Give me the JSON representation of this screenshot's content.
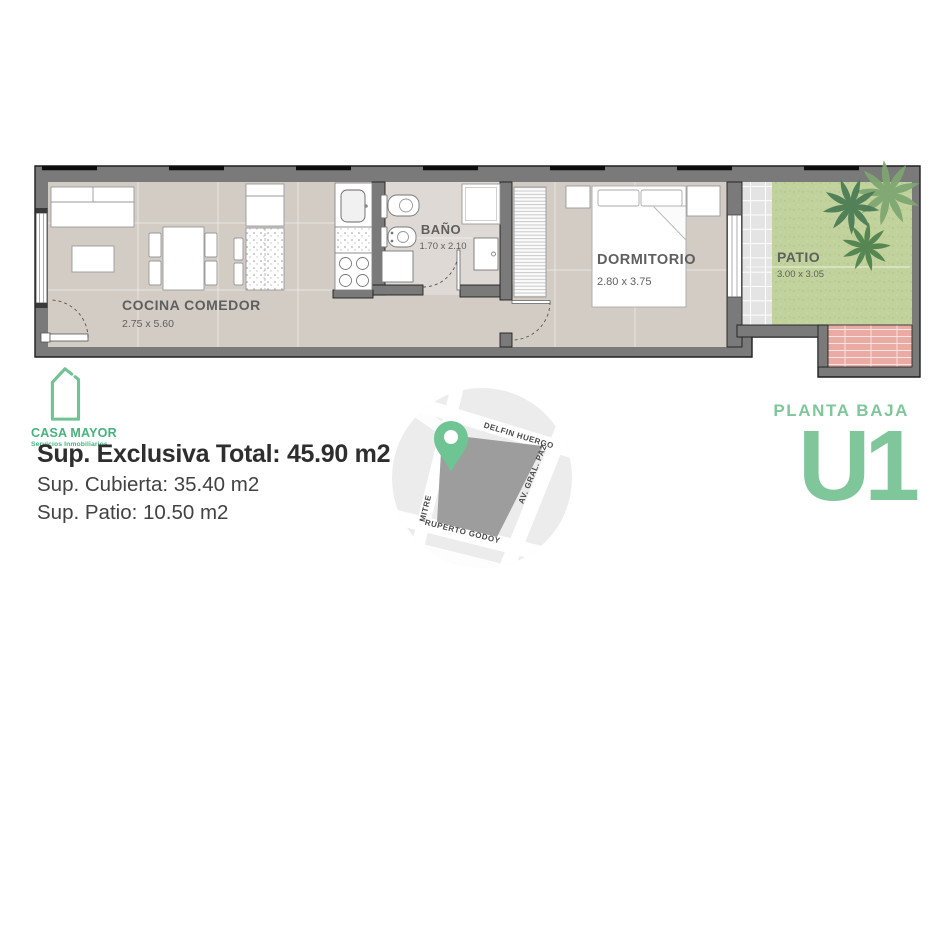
{
  "brand": {
    "name": "CASA MAYOR",
    "tagline": "Servicios Inmobiliarios"
  },
  "floorplan": {
    "rooms": [
      {
        "id": "cocina-comedor",
        "name": "COCINA COMEDOR",
        "dims": "2.75 x 5.60"
      },
      {
        "id": "bano",
        "name": "BAÑO",
        "dims": "1.70 x 2.10"
      },
      {
        "id": "dormitorio",
        "name": "DORMITORIO",
        "dims": "2.80 x 3.75"
      },
      {
        "id": "patio",
        "name": "PATIO",
        "dims": "3.00 x 3.05"
      }
    ]
  },
  "summary": {
    "exclusive_total": "Sup. Exclusiva Total: 45.90 m2",
    "covered": "Sup. Cubierta: 35.40 m2",
    "patio": "Sup. Patio: 10.50 m2"
  },
  "map": {
    "streets": {
      "top": "DELFIN HUERGO",
      "right": "AV. GRAL. PAZ",
      "left": "MITRE",
      "bottom": "RUPERTO GODOY"
    }
  },
  "unit": {
    "floor": "PLANTA BAJA",
    "code": "U1"
  },
  "colors": {
    "brand_green": "#45b37c",
    "unit_green": "#7fc79b",
    "pin_green": "#6ec492",
    "wall_gray": "#7a7a7a",
    "floor_beige": "#d2ccc5",
    "grass_green": "#c1d29c",
    "tile_pink": "#eaaba4",
    "map_block_gray": "#9d9d9d"
  }
}
